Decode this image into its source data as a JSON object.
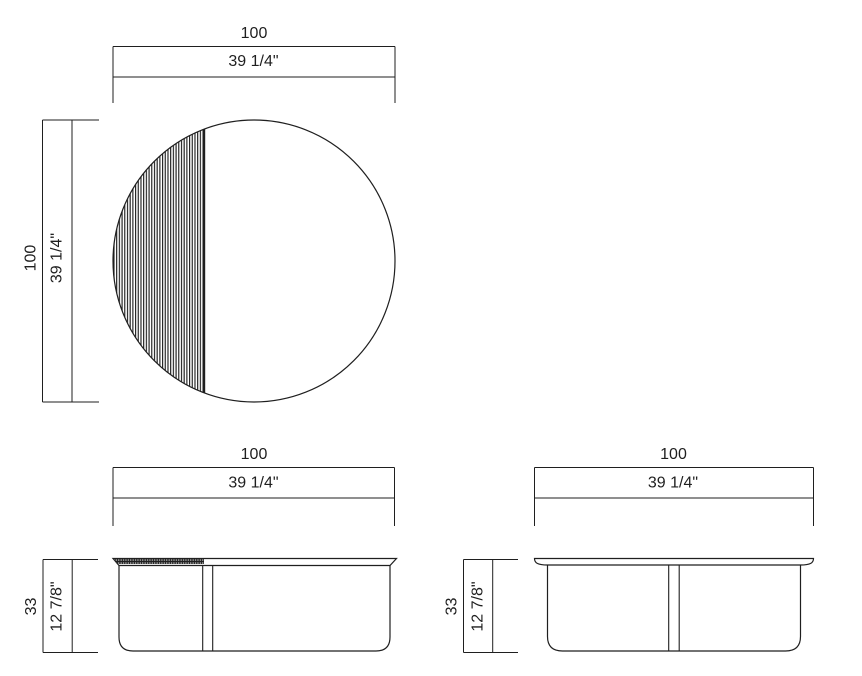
{
  "colors": {
    "background": "#ffffff",
    "line": "#1f1f1f"
  },
  "views": {
    "top": {
      "width": {
        "cm": "100",
        "inch": "39 1/4\""
      },
      "height": {
        "cm": "100",
        "inch": "39 1/4\""
      }
    },
    "front": {
      "width": {
        "cm": "100",
        "inch": "39 1/4\""
      },
      "height": {
        "cm": "33",
        "inch": "12 7/8\""
      }
    },
    "side": {
      "width": {
        "cm": "100",
        "inch": "39 1/4\""
      },
      "height": {
        "cm": "33",
        "inch": "12 7/8\""
      }
    }
  }
}
